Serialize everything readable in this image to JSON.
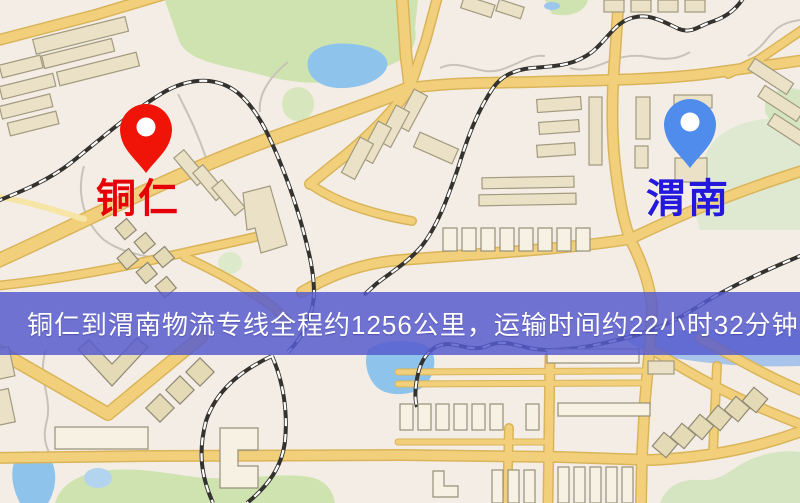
{
  "window": {
    "width": 800,
    "height": 503,
    "type": "static-route-map"
  },
  "map": {
    "markers": [
      {
        "id": "origin",
        "label": "铜仁",
        "pin_color": "#f01408",
        "label_color": "#e60008",
        "pin_style": "teardrop-with-hole"
      },
      {
        "id": "destination",
        "label": "渭南",
        "pin_color": "#4f8cec",
        "label_color": "#2318dc",
        "pin_style": "teardrop-with-hole"
      }
    ],
    "banner": {
      "text": "铜仁到渭南物流专线全程约1256公里，运输时间约22小时32分钟.",
      "background_color": "#565ace",
      "text_color": "#ffffff"
    },
    "route": {
      "distance_km": "1256",
      "duration": "22小时32分钟",
      "origin": "铜仁",
      "destination": "渭南"
    },
    "palette": {
      "background": "#f4ede5",
      "road_fill": "#f2d07b",
      "road_casing": "#d9b459",
      "railway": "#34322e",
      "park_green": "#cfe3b0",
      "water_blue": "#8ec4ec",
      "building": "#eae1c6"
    }
  }
}
